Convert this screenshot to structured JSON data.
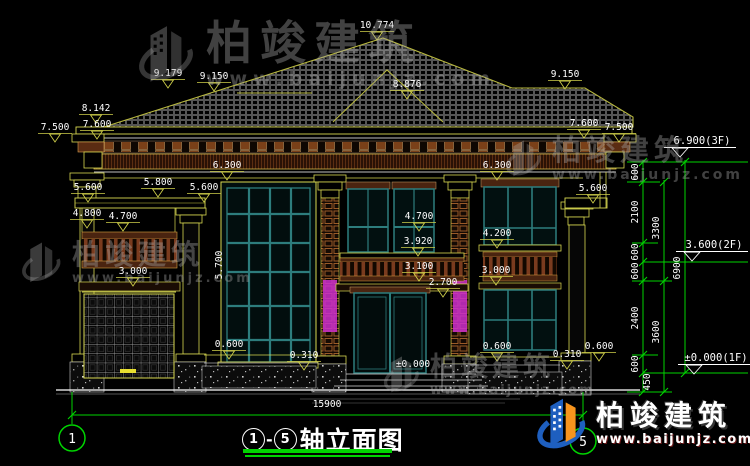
{
  "title": {
    "axis_from": "1",
    "dash": "-",
    "axis_to": "5",
    "label": "轴立面图"
  },
  "axes": {
    "left": "1",
    "right": "5"
  },
  "watermark": {
    "brand": "柏竣建筑",
    "url": "www.baijunjz.com"
  },
  "logo": {
    "brand": "柏竣建筑",
    "url": "www.baijunjz.com"
  },
  "colors": {
    "background": "#000000",
    "line_yellow": "#d8d850",
    "line_olive": "#b8b83e",
    "window_teal": "#2d7d7d",
    "axis_green": "#00d400",
    "cornice_brown": "#7a4018",
    "column_magenta": "#cc2fcc",
    "dim_text": "#ffffff",
    "logo_blue": "#1e5fbf",
    "logo_orange": "#f7941d"
  },
  "dim_labels": [
    {
      "t": "10.774",
      "x": 377,
      "y": 28,
      "m": 1
    },
    {
      "t": "9.179",
      "x": 168,
      "y": 76,
      "m": 1
    },
    {
      "t": "9.150",
      "x": 214,
      "y": 79,
      "m": 1
    },
    {
      "t": "8.876",
      "x": 407,
      "y": 87,
      "m": 1
    },
    {
      "t": "9.150",
      "x": 565,
      "y": 77,
      "m": 1
    },
    {
      "t": "8.142",
      "x": 96,
      "y": 111,
      "m": 1
    },
    {
      "t": "7.500",
      "x": 55,
      "y": 130,
      "m": 1
    },
    {
      "t": "7.600",
      "x": 97,
      "y": 127,
      "m": 1
    },
    {
      "t": "7.600",
      "x": 584,
      "y": 126,
      "m": 1
    },
    {
      "t": "7.500",
      "x": 619,
      "y": 130,
      "m": 1
    },
    {
      "t": "6.300",
      "x": 227,
      "y": 168,
      "m": 1
    },
    {
      "t": "6.300",
      "x": 497,
      "y": 168,
      "m": 1
    },
    {
      "t": "5.600",
      "x": 88,
      "y": 190,
      "m": 1
    },
    {
      "t": "5.800",
      "x": 158,
      "y": 185,
      "m": 1
    },
    {
      "t": "5.600",
      "x": 204,
      "y": 190,
      "m": 1
    },
    {
      "t": "5.600",
      "x": 593,
      "y": 191,
      "m": 1
    },
    {
      "t": "4.800",
      "x": 87,
      "y": 216,
      "m": 1
    },
    {
      "t": "4.700",
      "x": 123,
      "y": 219,
      "m": 1
    },
    {
      "t": "4.700",
      "x": 419,
      "y": 219,
      "m": 1
    },
    {
      "t": "3.920",
      "x": 418,
      "y": 244,
      "m": 1
    },
    {
      "t": "4.200",
      "x": 497,
      "y": 236,
      "m": 1
    },
    {
      "t": "3.100",
      "x": 419,
      "y": 269,
      "m": 1
    },
    {
      "t": "2.700",
      "x": 443,
      "y": 285,
      "m": 1
    },
    {
      "t": "3.000",
      "x": 133,
      "y": 274,
      "m": 1
    },
    {
      "t": "3.000",
      "x": 496,
      "y": 273,
      "m": 1
    },
    {
      "t": "5.700",
      "x": 222,
      "y": 265,
      "m": 0,
      "rot": -90
    },
    {
      "t": "0.600",
      "x": 229,
      "y": 347,
      "m": 1
    },
    {
      "t": "0.310",
      "x": 304,
      "y": 358,
      "m": 1
    },
    {
      "t": "0.600",
      "x": 497,
      "y": 349,
      "m": 1
    },
    {
      "t": "0.310",
      "x": 567,
      "y": 357,
      "m": 1
    },
    {
      "t": "0.600",
      "x": 599,
      "y": 349,
      "m": 1
    },
    {
      "t": "±0.000",
      "x": 413,
      "y": 367,
      "m": 0
    },
    {
      "t": "15900",
      "x": 327,
      "y": 407,
      "m": 0
    }
  ],
  "level_markers": [
    {
      "t": "6.900(3F)",
      "x": 702,
      "y": 144
    },
    {
      "t": "3.600(2F)",
      "x": 714,
      "y": 248
    },
    {
      "t": "±0.000(1F)",
      "x": 716,
      "y": 361
    }
  ],
  "chain_dims": [
    {
      "t": "600",
      "x": 638,
      "y": 172
    },
    {
      "t": "2100",
      "x": 638,
      "y": 212
    },
    {
      "t": "600",
      "x": 638,
      "y": 252
    },
    {
      "t": "600",
      "x": 638,
      "y": 271
    },
    {
      "t": "2400",
      "x": 638,
      "y": 318
    },
    {
      "t": "600",
      "x": 638,
      "y": 364
    },
    {
      "t": "450",
      "x": 650,
      "y": 382
    },
    {
      "t": "3300",
      "x": 659,
      "y": 228
    },
    {
      "t": "3600",
      "x": 659,
      "y": 332
    },
    {
      "t": "6900",
      "x": 680,
      "y": 268
    }
  ]
}
